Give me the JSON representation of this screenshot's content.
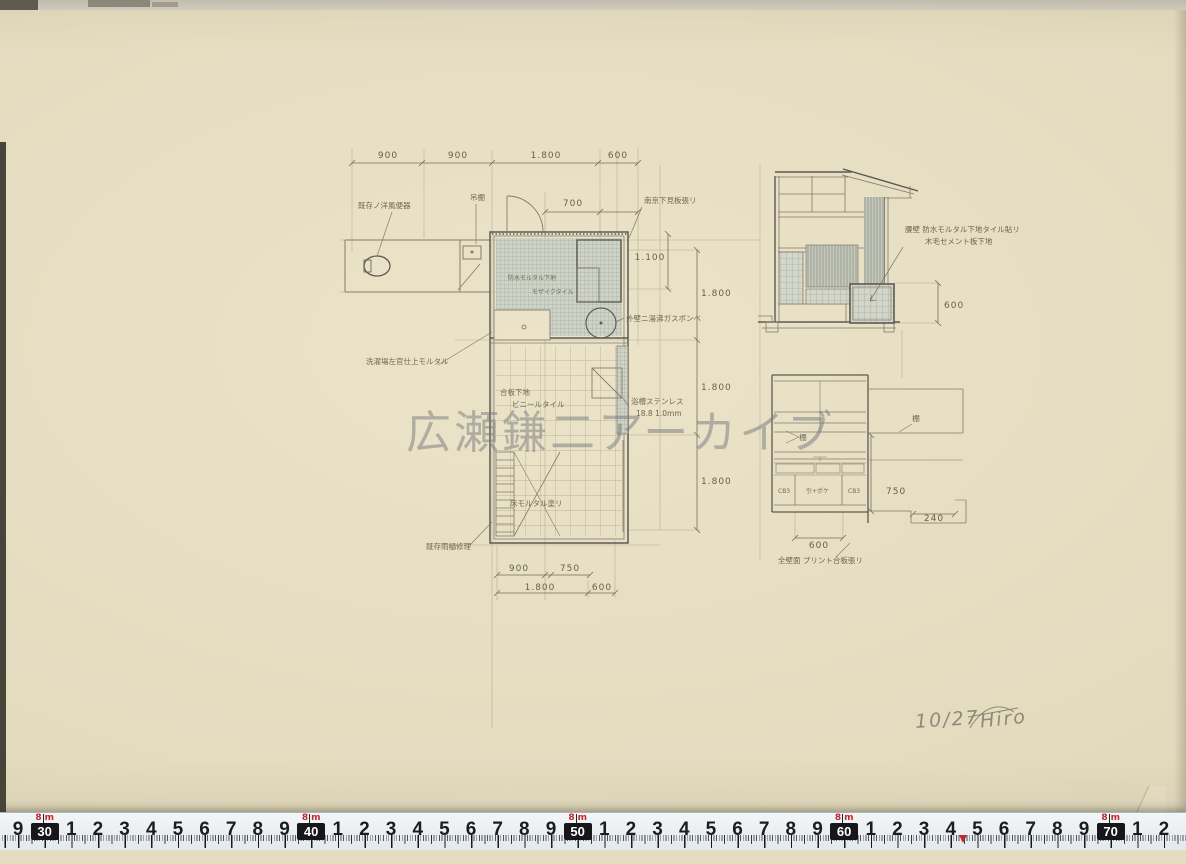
{
  "colors": {
    "paper": "#eae2c5",
    "pencil": "#6e6858",
    "accent_red": "#c3272b"
  },
  "watermark": {
    "text": "広瀬鎌二アーカイブ"
  },
  "plan": {
    "labels": {
      "toilet": "既存ノ洋風便器",
      "shelf": "吊棚",
      "siding": "南京下見板張リ",
      "waterproof": "防水モルタル下地",
      "mosaic": "モザイクタイル",
      "laundry": "洗濯場左官仕上モルタル",
      "gas": "外壁ニ湯沸ガスボンベ",
      "subfloor": "合板下地",
      "vinyl": "ビニールタイル",
      "bath_ss": "浴槽ステンレス",
      "bath_ss2": "18.8 1.0mm",
      "mortar": "床モルタル塗リ",
      "repair": "既存雨樋修理"
    },
    "dims": {
      "top1": "900",
      "top2": "900",
      "top3": "1.800",
      "top4": "600",
      "door": "700",
      "h1": "1.100",
      "v1": "1.800",
      "v2": "1.800",
      "v3": "1.800",
      "b1": "900",
      "b2": "750",
      "b3": "1.800",
      "b4": "600"
    }
  },
  "section": {
    "labels": {
      "wall1": "腰壁 防水モルタル下地タイル貼リ",
      "wall2": "木毛セメント板下地"
    },
    "dims": {
      "h600": "600"
    }
  },
  "cabinet": {
    "labels": {
      "shelf1": "棚",
      "shelf2": "棚",
      "plywood": "全壁面 プリント合板張リ",
      "code1": "CB3",
      "code2": "引+ポケ",
      "code3": "CB3"
    },
    "dims": {
      "v750": "750",
      "w240": "240",
      "w600": "600"
    }
  },
  "footer": {
    "date": "10/27",
    "signature": "Hiro"
  },
  "ruler": {
    "prefix": "8",
    "unit": "m",
    "start": 18,
    "step": 26.65,
    "sequence": [
      "9",
      "#30",
      "1",
      "2",
      "3",
      "4",
      "5",
      "6",
      "7",
      "8",
      "9",
      "#40",
      "1",
      "2",
      "3",
      "4",
      "5",
      "6",
      "7",
      "8",
      "9",
      "#50",
      "1",
      "2",
      "3",
      "4",
      "5",
      "6",
      "7",
      "8",
      "9",
      "#60",
      "1",
      "2",
      "3",
      "4",
      "5",
      "6",
      "7",
      "8",
      "9",
      "#70",
      "1",
      "2"
    ]
  }
}
